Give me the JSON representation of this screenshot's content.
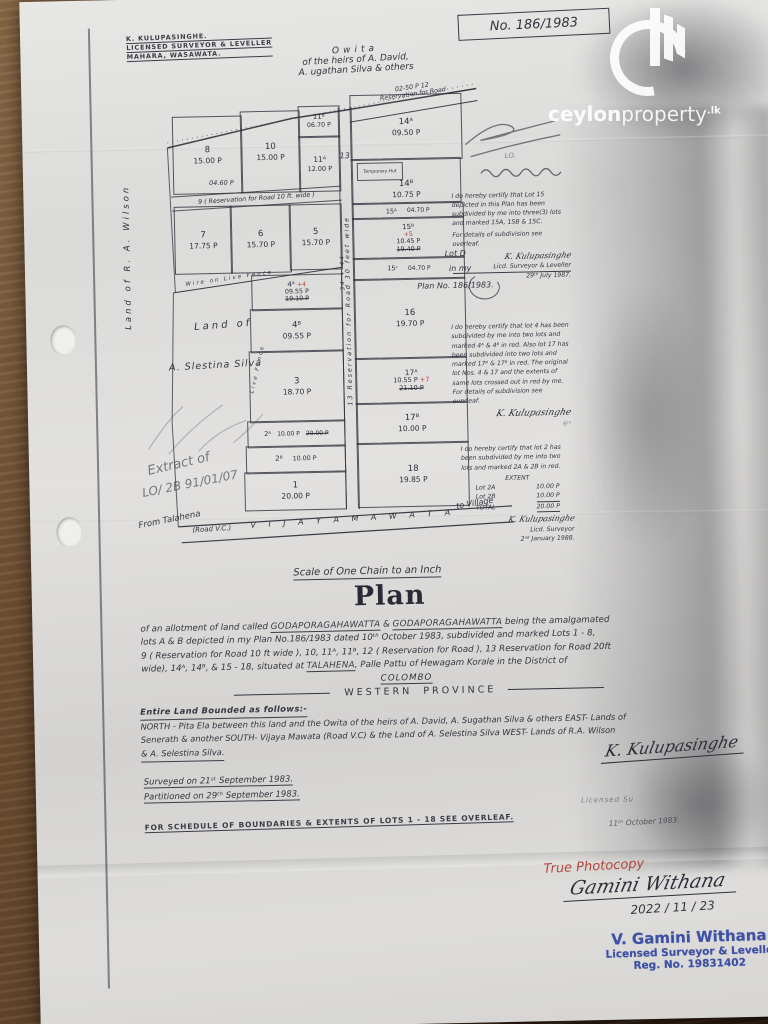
{
  "watermark": {
    "brand_bold": "ceylon",
    "brand_light": "property",
    "tld": "lk"
  },
  "plan_no": "No. 186/1983",
  "surveyor_header": {
    "line1": "K. KULUPASINGHE.",
    "line2": "LICENSED SURVEYOR & LEVELLER",
    "line3": "MAHARA, WASAWATA."
  },
  "north_neighbour": {
    "line1": "Owita",
    "line2": "of the heirs of A. David,",
    "line3": "A. ugathan Silva & others"
  },
  "west_neighbour_top": "Land of   R. A. Wilson",
  "west_neighbour_bottom": {
    "line1": "Land of",
    "line2": "A. Slestina Silva"
  },
  "fences": {
    "north": "Wire on Live Fence",
    "west": "Live Fence"
  },
  "plan": {
    "lots": [
      {
        "number": "8",
        "extent": "15.00 P"
      },
      {
        "number": "10",
        "extent": "15.00 P"
      },
      {
        "number": "11ᴮ",
        "extent": "06.70 P"
      },
      {
        "number": "11ᴬ",
        "extent": "12.00 P"
      },
      {
        "number": "7",
        "extent": "17.75 P"
      },
      {
        "number": "6",
        "extent": "15.70 P"
      },
      {
        "number": "5",
        "extent": "15.70 P"
      },
      {
        "number": "14ᴬ",
        "extent": "09.50 P"
      },
      {
        "number": "14ᴮ",
        "extent": "10.75 P"
      },
      {
        "number": "15ᴬ",
        "extent": "04.70 P"
      },
      {
        "number": "15ᴮ",
        "mark": "+5",
        "extent": "10.45 P",
        "old_extent": "19.40 P"
      },
      {
        "number": "15ᶜ",
        "extent": "04.70 P"
      },
      {
        "number": "16",
        "extent": "19.70 P"
      },
      {
        "number": "17ᴬ",
        "mark": "+7",
        "extent": "10.55 P",
        "old_extent": "21.10 P"
      },
      {
        "number": "17ᴮ",
        "extent": "10.00 P"
      },
      {
        "number": "18",
        "extent": "19.85 P"
      },
      {
        "number": "4ᴬ",
        "mark": "+4",
        "extent": "09.55 P",
        "old_extent": "19.10 P"
      },
      {
        "number": "4ᴮ",
        "extent": "09.55 P"
      },
      {
        "number": "3",
        "extent": "18.70 P"
      },
      {
        "number": "2ᴬ",
        "extent": "10.00 P",
        "old_extent": "20.00 P"
      },
      {
        "number": "2ᴮ",
        "extent": "10.00 P"
      },
      {
        "number": "1",
        "extent": "20.00 P"
      }
    ],
    "roads": {
      "road9_extent": "04.60 P",
      "road9": "9 ( Reservation for Road 10 ft. wide )",
      "road12_extent": "02-50 P   12",
      "road12_label": "Reservation for Road",
      "road13_no": "13",
      "road13_label": "13   Reservation   for   Road   30   feet   wide",
      "road13_measure": "34 + 44",
      "temporary_hut": "Temporary Hut"
    },
    "bottom_road": {
      "from": "From Talahena",
      "road_vc": "(Road V.C.)",
      "name": "V I J A Y A      M A W A T A",
      "to": "to Village"
    }
  },
  "margin_notes": {
    "lo": "LO.",
    "cert1": {
      "text": "I do hereby certify that Lot 15 depicted in this Plan has been subdivided by me into three(3) lots and marked 15A, 15B & 15C.",
      "text2": "For details of subdivision see overleaf.",
      "sig": "K. Kulupasinghe",
      "role": "Licd. Surveyor & Leveller",
      "date": "29ᵗʰ July 1987."
    },
    "lot_d": {
      "line1": "Lot D",
      "line2": "in my",
      "line3": "Plan No. 186/1983."
    },
    "cert2": {
      "text": "I do hereby certify that lot 4 has been subdivided by me into two lots and marked 4ᴬ & 4ᴮ in red. Also lot 17 has been subdivided into two lots and marked 17ᴬ & 17ᴮ in red. The original lot Nos. 4 & 17 and the extents of same lots crossed out in red by me. For details of subdivision see overleaf.",
      "sig": "K. Kulupasinghe",
      "date": "6ᵗʰ"
    },
    "cert3": {
      "text": "I do hereby certify that lot 2 has been subdivided by me into two lots and marked 2A & 2B in red.",
      "extent_heading": "EXTENT",
      "row1_label": "Lot 2A",
      "row1_val": "10.00 P",
      "row2_label": "Lot 2B",
      "row2_val": "10.00 P",
      "row3_label": "TOTAL",
      "row3_val": "20.00 P",
      "sig": "K. Kulupasinghe",
      "role": "Licd. Surveyor",
      "date": "2ⁿᵈ January 1988."
    }
  },
  "pencil_note": {
    "line1": "Extract of",
    "line2": "LO/ 2B  91/01/07"
  },
  "body": {
    "scale_line": "Scale of One Chain to an Inch",
    "title": "Plan",
    "desc": {
      "l1a": "of an allotment of land called ",
      "l1b": "GODAPORAGAHAWATTA",
      "l1c": " & ",
      "l1d": "GODAPORAGAHAWATTA",
      "l1e": " being the amalgamated",
      "l2": "lots A & B depicted in my Plan No.186/1983 dated 10ᵗʰ October 1983, subdivided and marked Lots 1 - 8,",
      "l3": "9 ( Reservation for Road 10 ft wide ), 10, 11ᴬ, 11ᴮ, 12 ( Reservation for Road ), 13 Reservation for Road 20ft",
      "l4a": "wide), 14ᴬ, 14ᴮ, & 15 - 18, situated at ",
      "l4b": "TALAHENA",
      "l4c": ", Palle Pattu of Hewagam Korale in the District of",
      "l5": "COLOMBO"
    },
    "province_w": "W E S T E R N",
    "province_p": "P R O V I N C E",
    "bounded_heading": "Entire Land Bounded as follows:-",
    "bounded_l1": "NORTH - Pita Ela between this land and the Owita of the heirs of A. David, A. Sugathan Silva & others EAST- Lands of",
    "bounded_l2": "Senerath & another SOUTH- Vijaya Mawata (Road V.C) & the Land of A. Selestina Silva WEST- Lands of R.A. Wilson",
    "bounded_l3": "& A. Selestina Silva.",
    "surveyed": "Surveyed on 21ˢᵗ September 1983.",
    "partitioned": "Partitioned on 29ᵗʰ September 1983.",
    "schedule": "FOR SCHEDULE OF BOUNDARIES & EXTENTS OF LOTS 1 - 18 SEE OVERLEAF.",
    "sig": "K. Kulupasinghe",
    "sig_sub1": "Licensed Su",
    "sig_sub2": "11ᵗʰ October 1983."
  },
  "footer": {
    "true_photocopy": "True Photocopy",
    "signature": "Gamini Withana",
    "date": "2022 / 11 / 23",
    "stamp_line1": "V. Gamini Withana",
    "stamp_line2": "Licensed Surveyor & Levelle",
    "stamp_line3": "Reg. No. 19831402"
  }
}
